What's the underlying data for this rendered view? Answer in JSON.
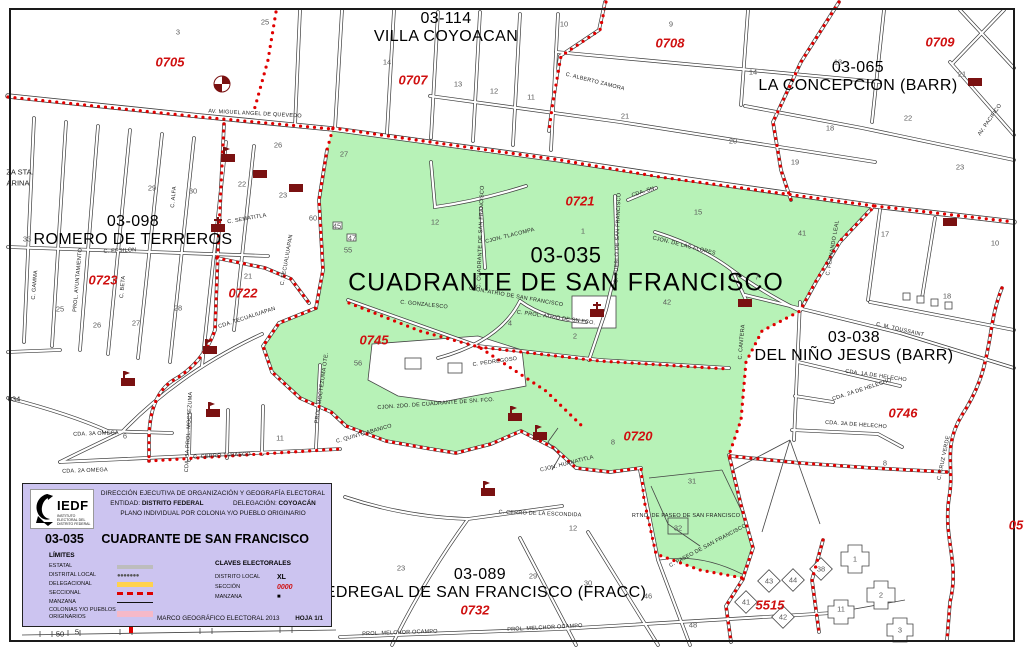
{
  "colors": {
    "colonia_green": "#b7f2b7",
    "boundary_red": "#e00000",
    "section_red": "#cf1010",
    "landmark_maroon": "#7a1111",
    "legend_lavender": "#ccc4f0",
    "delegacional_yellow": "#ffd24d",
    "colonias_pink": "#f6b9c8",
    "estatal_gray": "#bdbdbd"
  },
  "legend": {
    "logo_text": "IEDF",
    "logo_sub": "INSTITUTO ELECTORAL DEL DISTRITO FEDERAL",
    "org": "DIRECCIÓN EJECUTIVA DE ORGANIZACIÓN Y GEOGRAFÍA ELECTORAL",
    "entidad_label": "ENTIDAD:",
    "entidad_value": "DISTRITO FEDERAL",
    "delegacion_label": "DELEGACIÓN:",
    "delegacion_value": "COYOACÁN",
    "plano": "PLANO INDIVIDUAL POR COLONIA Y/O PUEBLO ORIGINARIO",
    "title_code": "03-035",
    "title_name": "CUADRANTE DE SAN FRANCISCO",
    "limites_heading": "LÍMITES",
    "limites": [
      {
        "label": "ESTATAL",
        "style": "estatal"
      },
      {
        "label": "DISTRITAL LOCAL",
        "style": "distrital"
      },
      {
        "label": "DELEGACIONAL",
        "style": "delegacional"
      },
      {
        "label": "SECCIONAL",
        "style": "seccional"
      },
      {
        "label": "MANZANA",
        "style": "manzana"
      },
      {
        "label": "COLONIAS Y/O PUEBLOS ORIGINARIOS",
        "style": "colonias"
      }
    ],
    "claves_heading": "CLAVES ELECTORALES",
    "claves": [
      {
        "label": "DISTRITO LOCAL",
        "value": "XL",
        "style": "bold"
      },
      {
        "label": "SECCIÓN",
        "value": "0000",
        "style": "red"
      },
      {
        "label": "MANZANA",
        "value": "■",
        "style": "square"
      }
    ],
    "footer": "MARCO GEOGRÁFICO ELECTORAL  2013",
    "hoja": "HOJA 1/1"
  },
  "map": {
    "colonies": [
      {
        "code": "03-114",
        "name": "VILLA COYOACAN",
        "x": 446,
        "y": 28,
        "big": false
      },
      {
        "code": "03-065",
        "name": "LA CONCEPCION (BARR)",
        "x": 858,
        "y": 77,
        "big": false
      },
      {
        "code": "03-098",
        "name": "ROMERO DE TERREROS",
        "x": 133,
        "y": 231,
        "big": false
      },
      {
        "code": "03-035",
        "name": "CUADRANTE DE SAN FRANCISCO",
        "x": 566,
        "y": 270,
        "big": true
      },
      {
        "code": "03-038",
        "name": "DEL NIÑO JESUS (BARR)",
        "x": 854,
        "y": 347,
        "big": false
      },
      {
        "code": "03-089",
        "name": "PEDREGAL DE SAN FRANCISCO (FRACC)",
        "x": 480,
        "y": 584,
        "big": false
      }
    ],
    "sections": [
      {
        "id": "0705",
        "x": 170,
        "y": 62
      },
      {
        "id": "0707",
        "x": 413,
        "y": 80
      },
      {
        "id": "0708",
        "x": 670,
        "y": 43
      },
      {
        "id": "0709",
        "x": 940,
        "y": 42
      },
      {
        "id": "0721",
        "x": 580,
        "y": 201
      },
      {
        "id": "0722",
        "x": 243,
        "y": 293
      },
      {
        "id": "0723",
        "x": 103,
        "y": 280
      },
      {
        "id": "0745",
        "x": 374,
        "y": 340
      },
      {
        "id": "0720",
        "x": 638,
        "y": 436
      },
      {
        "id": "0746",
        "x": 903,
        "y": 413
      },
      {
        "id": "0732",
        "x": 475,
        "y": 610
      },
      {
        "id": "5515",
        "x": 770,
        "y": 605
      },
      {
        "id": "05",
        "x": 1016,
        "y": 525
      }
    ],
    "blocks": [
      {
        "n": "3",
        "x": 178,
        "y": 32
      },
      {
        "n": "25",
        "x": 265,
        "y": 22
      },
      {
        "n": "14",
        "x": 387,
        "y": 62
      },
      {
        "n": "13",
        "x": 458,
        "y": 84
      },
      {
        "n": "12",
        "x": 494,
        "y": 91
      },
      {
        "n": "11",
        "x": 531,
        "y": 97
      },
      {
        "n": "10",
        "x": 564,
        "y": 24
      },
      {
        "n": "9",
        "x": 671,
        "y": 24
      },
      {
        "n": "21",
        "x": 625,
        "y": 116
      },
      {
        "n": "20",
        "x": 733,
        "y": 141
      },
      {
        "n": "19",
        "x": 795,
        "y": 162
      },
      {
        "n": "14",
        "x": 753,
        "y": 72
      },
      {
        "n": "13",
        "x": 838,
        "y": 62
      },
      {
        "n": "21",
        "x": 962,
        "y": 74
      },
      {
        "n": "18",
        "x": 830,
        "y": 128
      },
      {
        "n": "22",
        "x": 908,
        "y": 118
      },
      {
        "n": "23",
        "x": 960,
        "y": 167
      },
      {
        "n": "17",
        "x": 885,
        "y": 234
      },
      {
        "n": "10",
        "x": 995,
        "y": 243
      },
      {
        "n": "18",
        "x": 947,
        "y": 296
      },
      {
        "n": "29",
        "x": 152,
        "y": 188
      },
      {
        "n": "30",
        "x": 193,
        "y": 191
      },
      {
        "n": "33",
        "x": 27,
        "y": 239
      },
      {
        "n": "22",
        "x": 242,
        "y": 184
      },
      {
        "n": "23",
        "x": 283,
        "y": 195
      },
      {
        "n": "26",
        "x": 278,
        "y": 145
      },
      {
        "n": "25",
        "x": 60,
        "y": 309
      },
      {
        "n": "26",
        "x": 97,
        "y": 325
      },
      {
        "n": "27",
        "x": 136,
        "y": 323
      },
      {
        "n": "28",
        "x": 178,
        "y": 308
      },
      {
        "n": "21",
        "x": 248,
        "y": 276
      },
      {
        "n": "6",
        "x": 125,
        "y": 436
      },
      {
        "n": "11",
        "x": 280,
        "y": 438
      },
      {
        "n": "27",
        "x": 344,
        "y": 154
      },
      {
        "n": "60",
        "x": 313,
        "y": 218
      },
      {
        "n": "55",
        "x": 348,
        "y": 250
      },
      {
        "n": "45",
        "x": 337,
        "y": 226
      },
      {
        "n": "47",
        "x": 352,
        "y": 238
      },
      {
        "n": "1",
        "x": 583,
        "y": 231
      },
      {
        "n": "12",
        "x": 435,
        "y": 222
      },
      {
        "n": "15",
        "x": 698,
        "y": 212
      },
      {
        "n": "42",
        "x": 667,
        "y": 302
      },
      {
        "n": "4",
        "x": 510,
        "y": 323
      },
      {
        "n": "2",
        "x": 575,
        "y": 336
      },
      {
        "n": "7",
        "x": 757,
        "y": 277
      },
      {
        "n": "41",
        "x": 802,
        "y": 233
      },
      {
        "n": "56",
        "x": 358,
        "y": 363
      },
      {
        "n": "8",
        "x": 613,
        "y": 442
      },
      {
        "n": "31",
        "x": 692,
        "y": 481
      },
      {
        "n": "32",
        "x": 678,
        "y": 528
      },
      {
        "n": "8",
        "x": 885,
        "y": 463
      },
      {
        "n": "12",
        "x": 573,
        "y": 528
      },
      {
        "n": "23",
        "x": 401,
        "y": 568
      },
      {
        "n": "29",
        "x": 533,
        "y": 576
      },
      {
        "n": "30",
        "x": 588,
        "y": 583
      },
      {
        "n": "46",
        "x": 648,
        "y": 596
      },
      {
        "n": "48",
        "x": 693,
        "y": 625
      },
      {
        "n": "43",
        "x": 769,
        "y": 581
      },
      {
        "n": "44",
        "x": 793,
        "y": 580
      },
      {
        "n": "38",
        "x": 821,
        "y": 569
      },
      {
        "n": "41",
        "x": 746,
        "y": 602
      },
      {
        "n": "42",
        "x": 783,
        "y": 617
      },
      {
        "n": "11",
        "x": 841,
        "y": 609
      },
      {
        "n": "1",
        "x": 855,
        "y": 559
      },
      {
        "n": "2",
        "x": 881,
        "y": 595
      },
      {
        "n": "3",
        "x": 900,
        "y": 630
      }
    ],
    "streets": [
      {
        "t": "AV. MIGUEL ANGEL DE QUEVEDO",
        "x": 255,
        "y": 114,
        "r": 3
      },
      {
        "t": "C. ALBERTO ZAMORA",
        "x": 595,
        "y": 82,
        "r": 14
      },
      {
        "t": "CJON. TLACOMPA",
        "x": 510,
        "y": 236,
        "r": -14
      },
      {
        "t": "C. PUEBLO DE SAN FRANCISCO",
        "x": 618,
        "y": 238,
        "r": -88
      },
      {
        "t": "CJON. DE LAS FLORES",
        "x": 684,
        "y": 246,
        "r": 14
      },
      {
        "t": "CDA. SN.",
        "x": 644,
        "y": 192,
        "r": -18
      },
      {
        "t": "CJON. ATRIO DE SAN FRANCISCO",
        "x": 516,
        "y": 297,
        "r": 10
      },
      {
        "t": "C. PROL. ATRIO DE SN FCO.",
        "x": 556,
        "y": 318,
        "r": 8
      },
      {
        "t": "C. PEDREGOSO",
        "x": 495,
        "y": 362,
        "r": -8
      },
      {
        "t": "C. CUADRANTE DE SAN FRANCISCO",
        "x": 481,
        "y": 237,
        "r": -88
      },
      {
        "t": "C. GONZALESCO",
        "x": 424,
        "y": 305,
        "r": 6
      },
      {
        "t": "CJON. 2DO. DE CUADRANTE DE SN. FCO.",
        "x": 436,
        "y": 404,
        "r": -4
      },
      {
        "t": "C. QUINTO ABANICO",
        "x": 364,
        "y": 434,
        "r": -16
      },
      {
        "t": "C. CERRO TARASCO",
        "x": 222,
        "y": 456,
        "r": -3
      },
      {
        "t": "CJON. HUANATITLA",
        "x": 567,
        "y": 464,
        "r": -14
      },
      {
        "t": "C. CERRO DE LA ESCONDIDA",
        "x": 540,
        "y": 514,
        "r": 2
      },
      {
        "t": "RTNO. DE PASEO DE SAN FRANCISCO",
        "x": 686,
        "y": 516,
        "r": 0
      },
      {
        "t": "C. PASEO DE SAN FRANCISCO",
        "x": 708,
        "y": 546,
        "r": -28
      },
      {
        "t": "C. M. TOUSSAINT",
        "x": 900,
        "y": 330,
        "r": 13
      },
      {
        "t": "CDA. 1A DE HELECHO",
        "x": 876,
        "y": 376,
        "r": 8
      },
      {
        "t": "CDA. 2A DE HELECHO",
        "x": 862,
        "y": 390,
        "r": -18
      },
      {
        "t": "CDA. 3A DE HELECHO",
        "x": 856,
        "y": 425,
        "r": 4
      },
      {
        "t": "C. CRUZ VERDE",
        "x": 944,
        "y": 458,
        "r": -78
      },
      {
        "t": "C. CANTERA",
        "x": 742,
        "y": 342,
        "r": -85
      },
      {
        "t": "PROL. MELCHOR OCAMPO",
        "x": 545,
        "y": 628,
        "r": -3
      },
      {
        "t": "PROL. MELCHOR OCAMPO",
        "x": 400,
        "y": 633,
        "r": -2
      },
      {
        "t": "C. SEMATITLA",
        "x": 247,
        "y": 219,
        "r": -10
      },
      {
        "t": "C. EPSILON",
        "x": 120,
        "y": 251,
        "r": -3
      },
      {
        "t": "CDA. TECUALIUAPAN",
        "x": 247,
        "y": 318,
        "r": -18
      },
      {
        "t": "C. TECUALIUAPAN",
        "x": 287,
        "y": 260,
        "r": -80
      },
      {
        "t": "AV. PACIFICO",
        "x": 990,
        "y": 120,
        "r": -55
      },
      {
        "t": "CDA. 5A PROL. MOCTEZUMA",
        "x": 189,
        "y": 432,
        "r": -87
      },
      {
        "t": "PROL. MOCTEZUMA OTE.",
        "x": 322,
        "y": 388,
        "r": -82
      },
      {
        "t": "C. FERNANDO LEAL",
        "x": 833,
        "y": 248,
        "r": -80
      },
      {
        "t": "CDA. 3A OMEGA",
        "x": 96,
        "y": 434,
        "r": -2
      },
      {
        "t": "CDA. 2A OMEGA",
        "x": 85,
        "y": 471,
        "r": -2
      },
      {
        "t": "C. ALFA",
        "x": 174,
        "y": 197,
        "r": -85
      },
      {
        "t": "C. BETA",
        "x": 123,
        "y": 287,
        "r": -85
      },
      {
        "t": "C. GAMMA",
        "x": 35,
        "y": 285,
        "r": -85
      },
      {
        "t": "PROL. AYUNTAMIENTO",
        "x": 78,
        "y": 280,
        "r": -85
      }
    ],
    "edge_labels": [
      {
        "t": "ZA STA.",
        "x": 20,
        "y": 172
      },
      {
        "t": "ARINA",
        "x": 18,
        "y": 183
      },
      {
        "t": "034",
        "x": 14,
        "y": 399
      },
      {
        "t": "50",
        "x": 60,
        "y": 634
      },
      {
        "t": "5",
        "x": 77,
        "y": 632
      }
    ],
    "icons": [
      {
        "type": "church-icon",
        "x": 218,
        "y": 228
      },
      {
        "type": "church-icon",
        "x": 597,
        "y": 313
      },
      {
        "type": "school-flag-icon",
        "x": 228,
        "y": 158
      },
      {
        "type": "school-flag-icon",
        "x": 210,
        "y": 350
      },
      {
        "type": "school-flag-icon",
        "x": 128,
        "y": 382
      },
      {
        "type": "school-flag-icon",
        "x": 213,
        "y": 413
      },
      {
        "type": "school-flag-icon",
        "x": 515,
        "y": 417
      },
      {
        "type": "school-flag-icon",
        "x": 540,
        "y": 436
      },
      {
        "type": "school-flag-icon",
        "x": 488,
        "y": 492
      },
      {
        "type": "building-icon",
        "x": 260,
        "y": 174
      },
      {
        "type": "building-icon",
        "x": 296,
        "y": 188
      },
      {
        "type": "building-icon",
        "x": 975,
        "y": 82
      },
      {
        "type": "building-icon",
        "x": 950,
        "y": 222
      },
      {
        "type": "building-icon",
        "x": 745,
        "y": 303
      },
      {
        "type": "compass-icon",
        "x": 222,
        "y": 84
      }
    ]
  }
}
